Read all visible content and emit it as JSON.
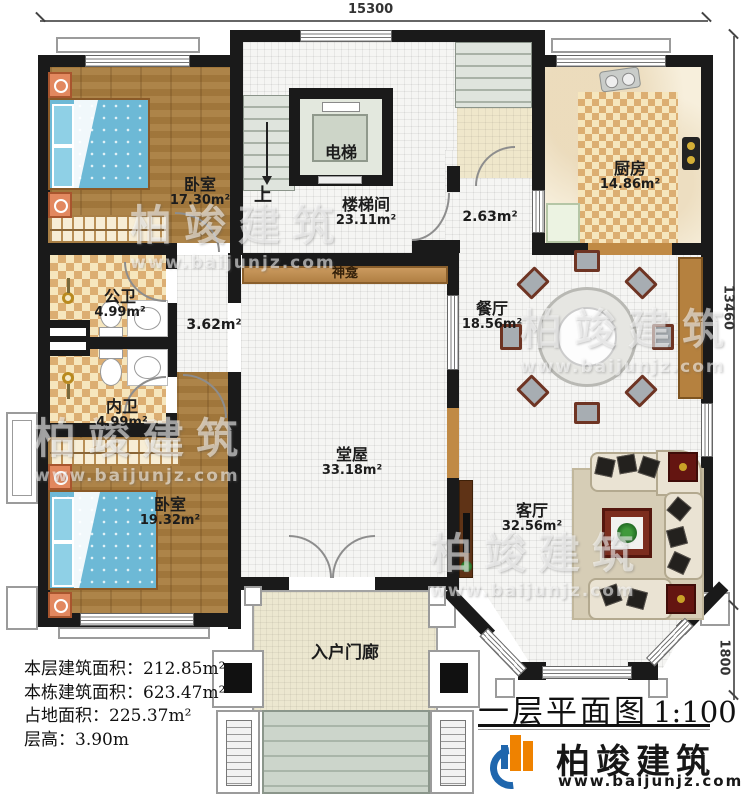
{
  "dimensions": {
    "top": "15300",
    "right": "13460",
    "bottom_right": "1800"
  },
  "rooms": {
    "bedroom1": {
      "name": "卧室",
      "area": "17.30m²"
    },
    "elevator": {
      "name": "电梯"
    },
    "stairwell": {
      "name": "楼梯间",
      "area": "23.11m²",
      "direction": "上"
    },
    "kitchen": {
      "name": "厨房",
      "area": "14.86m²"
    },
    "stair_landing": {
      "area": "2.63m²"
    },
    "public_bath": {
      "name": "公卫",
      "area": "4.99m²"
    },
    "private_bath": {
      "name": "内卫",
      "area": "4.99m²"
    },
    "corridor": {
      "area": "3.62m²"
    },
    "shrine": {
      "name": "神龛"
    },
    "hall": {
      "name": "堂屋",
      "area": "33.18m²"
    },
    "dining": {
      "name": "餐厅",
      "area": "18.56m²"
    },
    "living": {
      "name": "客厅",
      "area": "32.56m²"
    },
    "bedroom2": {
      "name": "卧室",
      "area": "19.32m²"
    },
    "porch": {
      "name": "入户门廊"
    }
  },
  "stats": {
    "floor_area": "本层建筑面积：212.85m²",
    "total_area": "本栋建筑面积：623.47m²",
    "footprint": "占地面积：225.37m²",
    "floor_height": "层高：3.90m"
  },
  "title": {
    "name": "一层平面图",
    "scale": "1:100"
  },
  "brand": {
    "name": "柏竣建筑",
    "url": "www.baijunjz.com"
  },
  "watermark": {
    "name": "柏竣建筑",
    "url": "www.baijunjz.com"
  },
  "colors": {
    "wall": "#1a1a1a",
    "wood": "#a87c3e",
    "bed_blue": "#6db9d6",
    "checker": "#dcae72",
    "brand_blue": "#1f66ad",
    "brand_orange": "#ef8200"
  }
}
